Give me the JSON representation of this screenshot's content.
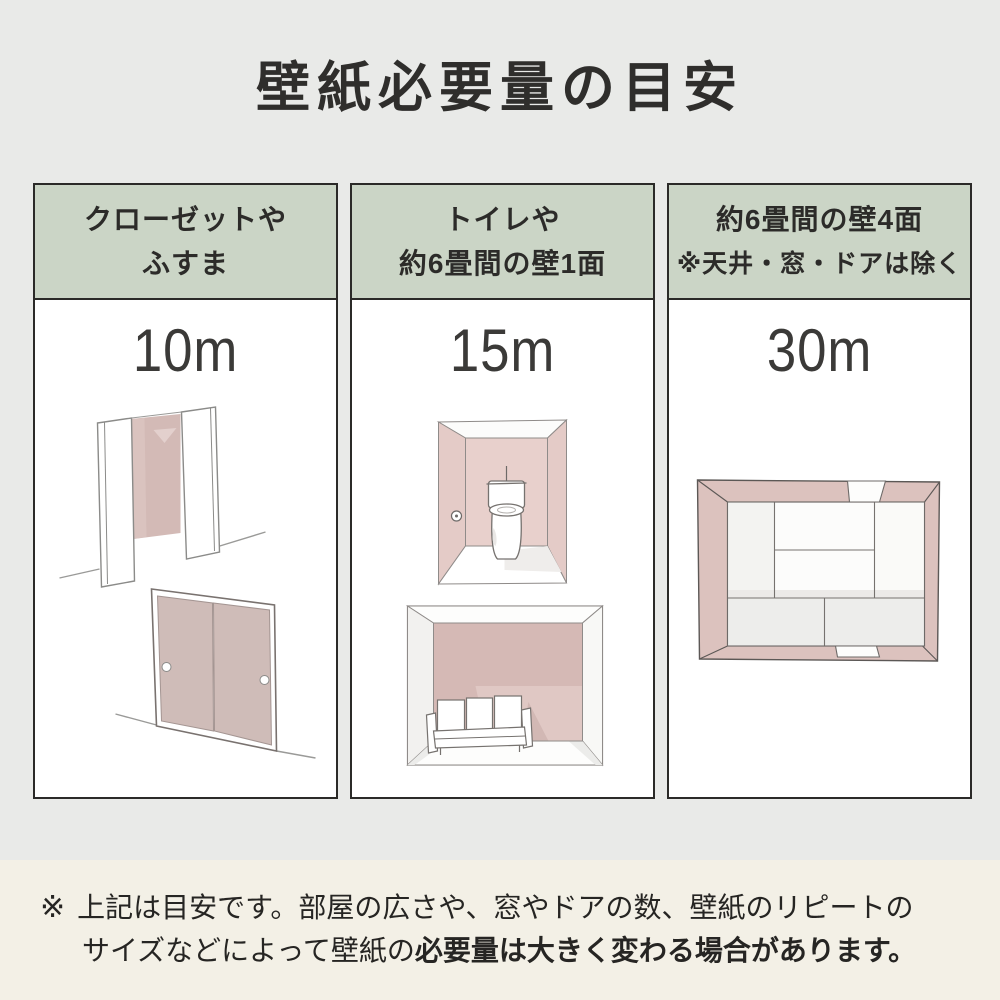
{
  "page": {
    "title": "壁紙必要量の目安"
  },
  "theme": {
    "page_bg": "#e9eae8",
    "footer_bg": "#f3f0e6",
    "header_green": "#cbd5c6",
    "border_dark": "#2b2a28",
    "accent_pink": "#d5bcb8"
  },
  "columns": [
    {
      "id": "closet-fusuma",
      "header_lines": [
        "クローゼットや",
        "ふすま"
      ],
      "amount": "10m",
      "illustrations": [
        "closet-open-doors",
        "fusuma-sliding-doors"
      ]
    },
    {
      "id": "toilet-one-wall",
      "header_lines": [
        "トイレや",
        "約6畳間の壁1面"
      ],
      "amount": "15m",
      "illustrations": [
        "toilet-room",
        "room-one-accent-wall"
      ]
    },
    {
      "id": "four-walls",
      "header_lines": [
        "約6畳間の壁4面",
        "※天井・窓・ドアは除く"
      ],
      "amount": "30m",
      "illustrations": [
        "six-tatami-room-top-view"
      ]
    }
  ],
  "footer": {
    "marker": "※",
    "line1": "上記は目安です。部屋の広さや、窓やドアの数、壁紙のリピートの",
    "line2_normal": "サイズなどによって壁紙の",
    "line2_bold": "必要量は大きく変わる場合があります。"
  }
}
